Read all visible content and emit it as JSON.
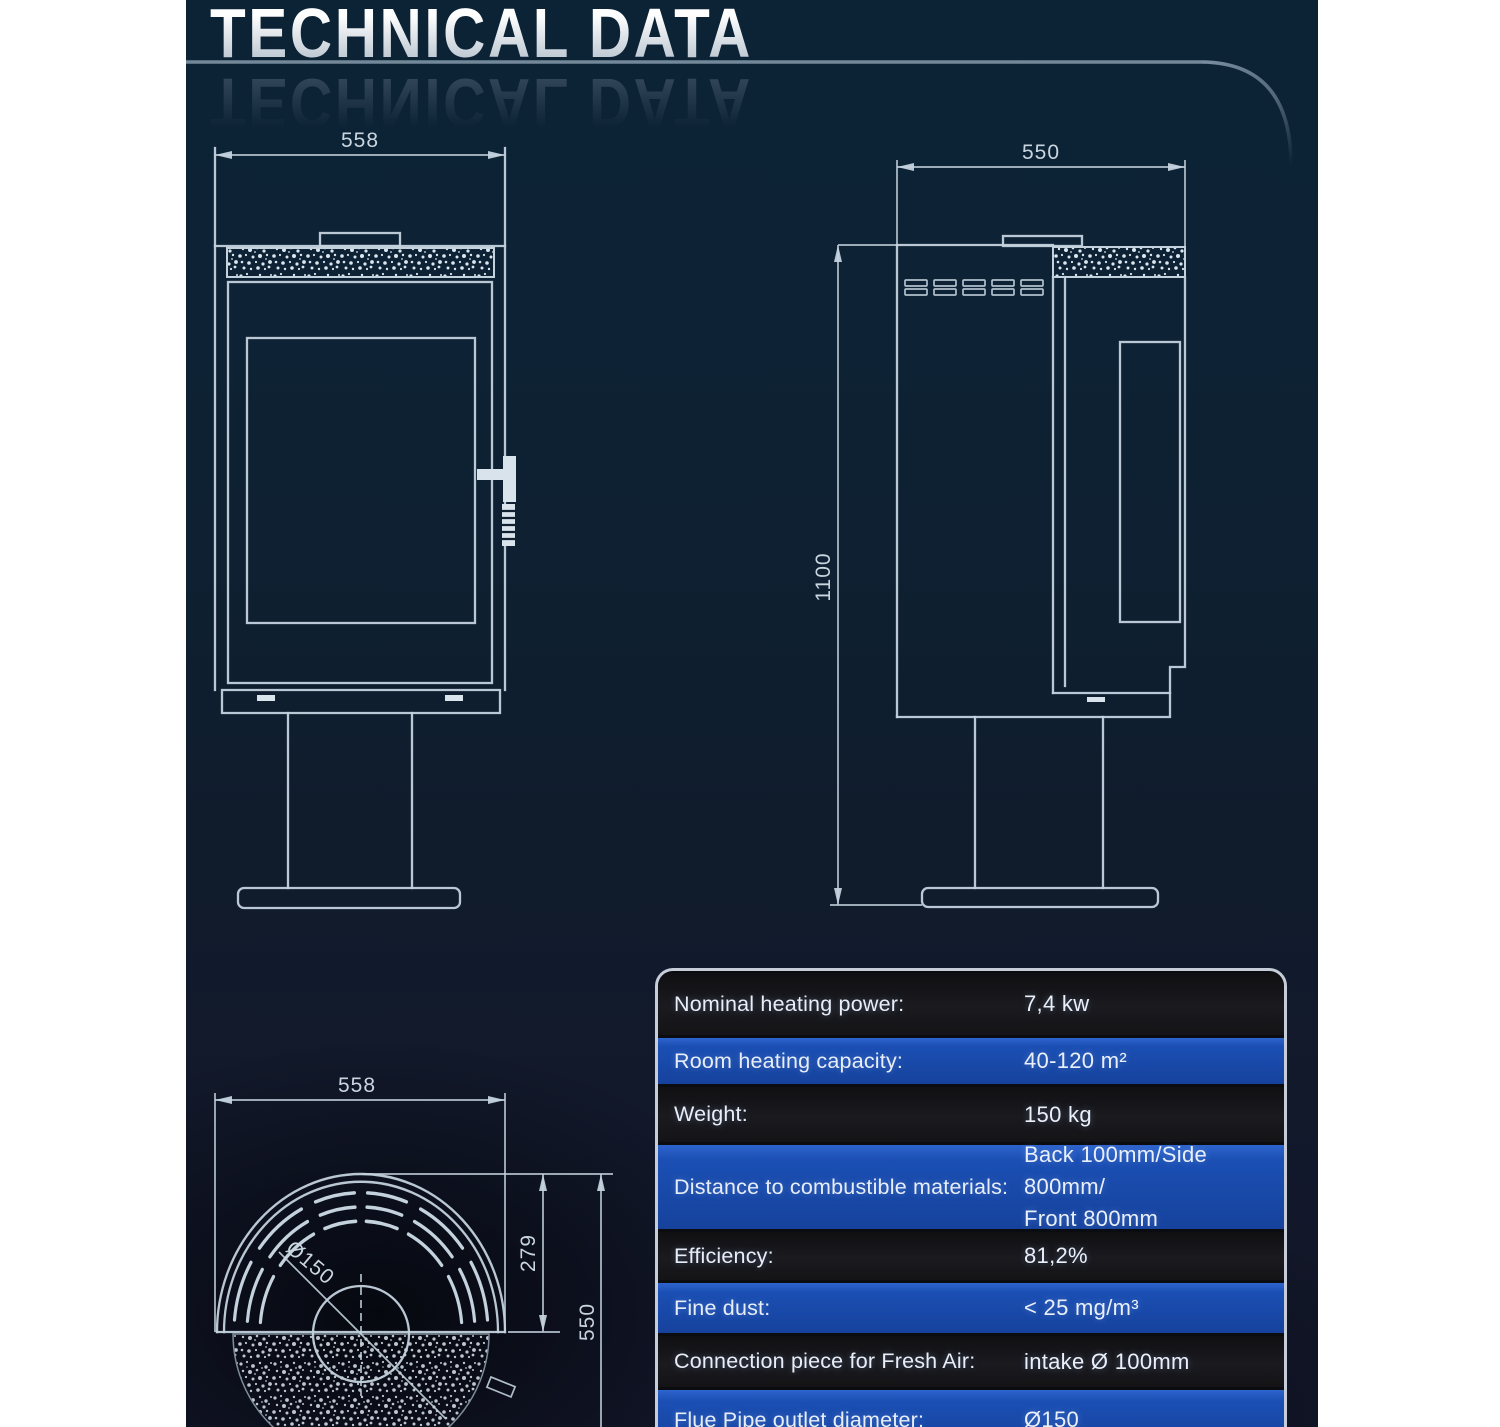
{
  "page": {
    "title": "TECHNICAL DATA"
  },
  "colors": {
    "panel_navy": "#0e2133",
    "row_blue": "#1b4fb4",
    "row_dark": "#141417",
    "drawing_line": "#c3d2dd",
    "page_white": "#ffffff",
    "table_border": "#c6cdd8"
  },
  "drawings": {
    "front_view": {
      "name": "stove front view",
      "width_label": "558"
    },
    "side_view": {
      "name": "stove side view",
      "depth_label": "550",
      "height_label": "1100"
    },
    "top_view": {
      "name": "stove top view",
      "width_label": "558",
      "radius_label": "279",
      "depth_label": "550",
      "flue_label": "Ø150"
    }
  },
  "table": {
    "rows": [
      {
        "label": "Nominal heating power:",
        "value": "7,4 kw"
      },
      {
        "label": "Room heating capacity:",
        "value": "40-120 m²"
      },
      {
        "label": "Weight:",
        "value": "150 kg"
      },
      {
        "label": "Distance to combustible materials:",
        "value": "Back 100mm/Side 800mm/",
        "value2": "Front 800mm"
      },
      {
        "label": "Efficiency:",
        "value": "81,2%"
      },
      {
        "label": "Fine dust:",
        "value": "< 25 mg/m³"
      },
      {
        "label": "Connection piece for Fresh Air:",
        "value": "intake Ø 100mm"
      },
      {
        "label": "Flue Pipe outlet diameter:",
        "value": "Ø150"
      }
    ]
  }
}
